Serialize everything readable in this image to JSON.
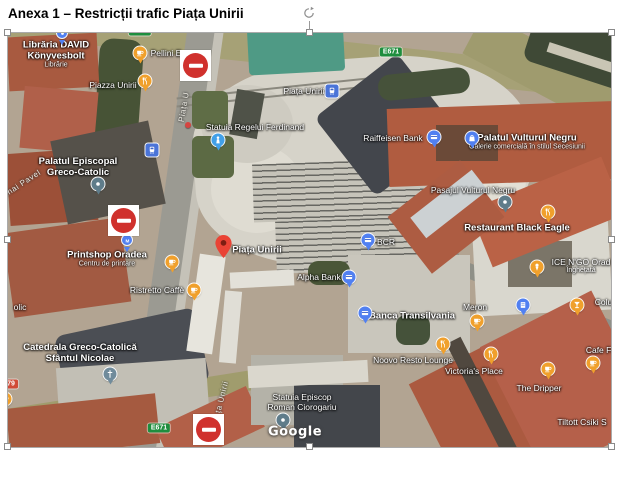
{
  "title": "Anexa 1 – Restricții trafic Piața Unirii",
  "colors": {
    "poi_orange": "#f0a02c",
    "poi_blue": "#5180f1",
    "transit_blue": "#4a74d8",
    "dot_slate": "#5f7c8a",
    "church_slate": "#708b9b",
    "monument_blue": "#42a0e8",
    "shield_green": "#1e8e3e",
    "shield_red": "#d04b37",
    "sign_red": "#d0312d",
    "pin_red": "#EA4335"
  },
  "map": {
    "attribution": "Google",
    "items": [
      {
        "name": "libraria-david-label",
        "kind": "label",
        "size": "l",
        "text": "Librăria DAVID",
        "text2": "Könyvesbolt",
        "sub": "Librărie",
        "x": 48,
        "y": 22
      },
      {
        "name": "blue-pin-partial-icon",
        "kind": "icon",
        "glyph": "dot",
        "shape": "sm",
        "color": "#5180f1",
        "x": 54,
        "y": 0
      },
      {
        "name": "cafe-icon",
        "kind": "icon",
        "glyph": "cafe",
        "color": "#f0a02c",
        "x": 132,
        "y": 20
      },
      {
        "name": "pellini-label",
        "kind": "label",
        "text": "Pellini E",
        "x": 158,
        "y": 20
      },
      {
        "name": "piazza-unirii-label",
        "kind": "label",
        "text": "Piazza Unirii",
        "x": 105,
        "y": 52
      },
      {
        "name": "restaurant-icon",
        "kind": "icon",
        "glyph": "restaurant",
        "color": "#f0a02c",
        "x": 137,
        "y": 48
      },
      {
        "name": "e671-shield-top-left",
        "kind": "shield",
        "text": "E671",
        "color": "#1e8e3e",
        "x": 132,
        "y": -2
      },
      {
        "name": "e671-shield-top-right",
        "kind": "shield",
        "text": "E671",
        "color": "#1e8e3e",
        "x": 383,
        "y": 19
      },
      {
        "name": "piata-u-street-label",
        "kind": "street",
        "text": "Piața U",
        "x": 176,
        "y": 74,
        "rotate": -80
      },
      {
        "name": "piata-unirii-transit-label",
        "kind": "label",
        "text": "Piața Unirii",
        "x": 296,
        "y": 58
      },
      {
        "name": "tram-stop-icon",
        "kind": "icon",
        "glyph": "tram",
        "shape": "sq",
        "color": "#4a74d8",
        "x": 324,
        "y": 58
      },
      {
        "name": "statuia-ferdinand-label",
        "kind": "label",
        "text": "Statuia Regelui Ferdinand",
        "x": 247,
        "y": 94
      },
      {
        "name": "monument-icon",
        "kind": "icon",
        "glyph": "monument",
        "color": "#42a0e8",
        "x": 210,
        "y": 107
      },
      {
        "name": "red-dot",
        "kind": "icon",
        "glyph": "",
        "shape": "mini",
        "color": "#d64541",
        "x": 180,
        "y": 92
      },
      {
        "name": "raiffeisen-bank-label",
        "kind": "label",
        "text": "Raiffeisen Bank",
        "x": 385,
        "y": 105
      },
      {
        "name": "bank-icon",
        "kind": "icon",
        "glyph": "bank",
        "color": "#5180f1",
        "x": 426,
        "y": 104
      },
      {
        "name": "palatul-vulturul-negru-label",
        "kind": "label",
        "size": "l",
        "text": "Palatul Vulturul Negru",
        "sub": "Galerie comercială în stilul Secesiunii",
        "x": 519,
        "y": 109
      },
      {
        "name": "mall-icon",
        "kind": "icon",
        "glyph": "mall",
        "color": "#5180f1",
        "x": 464,
        "y": 105
      },
      {
        "name": "pasajul-vulturul-negru-label",
        "kind": "label",
        "text": "Pasajul Vulturul Negru",
        "x": 465,
        "y": 157
      },
      {
        "name": "dot-icon",
        "kind": "icon",
        "glyph": "dot",
        "color": "#5f7c8a",
        "x": 497,
        "y": 169
      },
      {
        "name": "restaurant-black-eagle-label",
        "kind": "label",
        "size": "l",
        "text": "Restaurant Black Eagle",
        "x": 509,
        "y": 195
      },
      {
        "name": "restaurant-icon",
        "kind": "icon",
        "glyph": "restaurant",
        "color": "#f0a02c",
        "x": 540,
        "y": 179
      },
      {
        "name": "bcr-label",
        "kind": "label",
        "text": "BCR",
        "x": 378,
        "y": 209
      },
      {
        "name": "bank-icon",
        "kind": "icon",
        "glyph": "bank",
        "color": "#5180f1",
        "x": 360,
        "y": 207
      },
      {
        "name": "ice-n-go-label",
        "kind": "label",
        "text": "ICE N'GO Orad",
        "sub": "Înghețată",
        "x": 573,
        "y": 233
      },
      {
        "name": "icecream-icon",
        "kind": "icon",
        "glyph": "icecream",
        "color": "#f0a02c",
        "x": 529,
        "y": 234
      },
      {
        "name": "palatul-episcopal-label",
        "kind": "label",
        "size": "l",
        "text": "Palatul Episcopal",
        "text2": "Greco-Catolic",
        "x": 70,
        "y": 134
      },
      {
        "name": "dot-icon",
        "kind": "icon",
        "glyph": "dot",
        "color": "#5f7c8a",
        "x": 90,
        "y": 151
      },
      {
        "name": "mihai-pavel-street-label",
        "kind": "street",
        "text": "Mihai Pavel",
        "x": 12,
        "y": 152,
        "rotate": -33
      },
      {
        "name": "bus-stop-icon",
        "kind": "icon",
        "glyph": "tram",
        "shape": "sq",
        "color": "#4a74d8",
        "x": 144,
        "y": 117
      },
      {
        "name": "no-entry-sign",
        "kind": "sign",
        "x": 172,
        "y": 17
      },
      {
        "name": "no-entry-sign",
        "kind": "sign",
        "x": 100,
        "y": 172
      },
      {
        "name": "no-entry-sign",
        "kind": "sign",
        "x": 185,
        "y": 381
      },
      {
        "name": "printshop-oradea-label",
        "kind": "label",
        "size": "l",
        "text": "Printshop Oradea",
        "sub": "Centru de printare",
        "x": 99,
        "y": 226
      },
      {
        "name": "print-pin-icon",
        "kind": "icon",
        "glyph": "m",
        "shape": "sm",
        "color": "#5180f1",
        "x": 119,
        "y": 207
      },
      {
        "name": "cafe-icon",
        "kind": "icon",
        "glyph": "cafe",
        "color": "#f0a02c",
        "x": 164,
        "y": 229
      },
      {
        "name": "ristretto-caffe-label",
        "kind": "label",
        "text": "Ristretto Caffè",
        "x": 149,
        "y": 257
      },
      {
        "name": "cafe-icon",
        "kind": "icon",
        "glyph": "cafe",
        "color": "#f0a02c",
        "x": 186,
        "y": 257
      },
      {
        "name": "olic-fragment-label",
        "kind": "label",
        "text": "olic",
        "x": 12,
        "y": 274
      },
      {
        "name": "catedrala-label",
        "kind": "label",
        "size": "l",
        "text": "Catedrala Greco-Catolică",
        "text2": "Sfântul Nicolae",
        "x": 72,
        "y": 320
      },
      {
        "name": "church-icon",
        "kind": "icon",
        "glyph": "church",
        "color": "#708b9b",
        "x": 102,
        "y": 341
      },
      {
        "name": "dn79-shield",
        "kind": "shield",
        "text": "79",
        "color": "#d04b37",
        "x": 3,
        "y": 351
      },
      {
        "name": "cafe-icon",
        "kind": "icon",
        "glyph": "cafe",
        "color": "#f0a02c",
        "x": -3,
        "y": 366
      },
      {
        "name": "e671-shield-bottom",
        "kind": "shield",
        "text": "E671",
        "color": "#1e8e3e",
        "x": 151,
        "y": 395
      },
      {
        "name": "ta-unirii-street-label",
        "kind": "street",
        "text": "ța Unirii",
        "x": 214,
        "y": 364,
        "rotate": -76
      },
      {
        "name": "red-map-pin",
        "kind": "pin-red",
        "x": 215,
        "y": 225
      },
      {
        "name": "piata-unirii-pin-label",
        "kind": "label",
        "size": "l",
        "text": "Piața Unirii",
        "x": 249,
        "y": 217
      },
      {
        "name": "alpha-bank-label",
        "kind": "label",
        "text": "Alpha Bank",
        "x": 311,
        "y": 244
      },
      {
        "name": "bank-icon",
        "kind": "icon",
        "glyph": "bank",
        "color": "#5180f1",
        "x": 341,
        "y": 244
      },
      {
        "name": "banca-transilvania-label",
        "kind": "label",
        "size": "l",
        "text": "Banca Transilvania",
        "x": 404,
        "y": 283
      },
      {
        "name": "bank-icon",
        "kind": "icon",
        "glyph": "bank",
        "color": "#5180f1",
        "x": 357,
        "y": 280
      },
      {
        "name": "noovo-resto-lounge-label",
        "kind": "label",
        "text": "Noovo Resto Lounge",
        "x": 405,
        "y": 327
      },
      {
        "name": "restaurant-icon",
        "kind": "icon",
        "glyph": "restaurant",
        "color": "#f0a02c",
        "x": 435,
        "y": 311
      },
      {
        "name": "victorias-place-label",
        "kind": "label",
        "text": "Victoria's Place",
        "x": 466,
        "y": 338
      },
      {
        "name": "restaurant-icon",
        "kind": "icon",
        "glyph": "restaurant",
        "color": "#f0a02c",
        "x": 483,
        "y": 321
      },
      {
        "name": "meron-label",
        "kind": "label",
        "text": "Meron",
        "x": 467,
        "y": 274
      },
      {
        "name": "cafe-icon",
        "kind": "icon",
        "glyph": "cafe",
        "color": "#f0a02c",
        "x": 469,
        "y": 288
      },
      {
        "name": "hotel-pin-icon",
        "kind": "icon",
        "glyph": "hotel",
        "color": "#5180f1",
        "x": 515,
        "y": 272
      },
      {
        "name": "colum-label",
        "kind": "label",
        "text": "Colum",
        "x": 599,
        "y": 269
      },
      {
        "name": "cocktail-icon",
        "kind": "icon",
        "glyph": "cocktail",
        "color": "#f0a02c",
        "x": 569,
        "y": 272
      },
      {
        "name": "cafe-fr-label",
        "kind": "label",
        "text": "Cafe Fr",
        "x": 592,
        "y": 317
      },
      {
        "name": "cafe-icon",
        "kind": "icon",
        "glyph": "cafe",
        "color": "#f0a02c",
        "x": 585,
        "y": 330
      },
      {
        "name": "the-dripper-label",
        "kind": "label",
        "text": "The Dripper",
        "x": 531,
        "y": 355
      },
      {
        "name": "cafe-icon",
        "kind": "icon",
        "glyph": "cafe",
        "color": "#f0a02c",
        "x": 540,
        "y": 336
      },
      {
        "name": "tiltott-csiki-label",
        "kind": "label",
        "text": "Tiltott Csiki S",
        "x": 574,
        "y": 389
      },
      {
        "name": "statuia-episcop-label",
        "kind": "label",
        "text": "Statuia Episcop",
        "text2": "Roman Ciorogariu",
        "x": 294,
        "y": 369
      },
      {
        "name": "dot-icon",
        "kind": "icon",
        "glyph": "dot",
        "color": "#5f7c8a",
        "x": 275,
        "y": 387
      },
      {
        "name": "google-watermark",
        "kind": "watermark",
        "text": "Google",
        "x": 287,
        "y": 399
      }
    ]
  }
}
